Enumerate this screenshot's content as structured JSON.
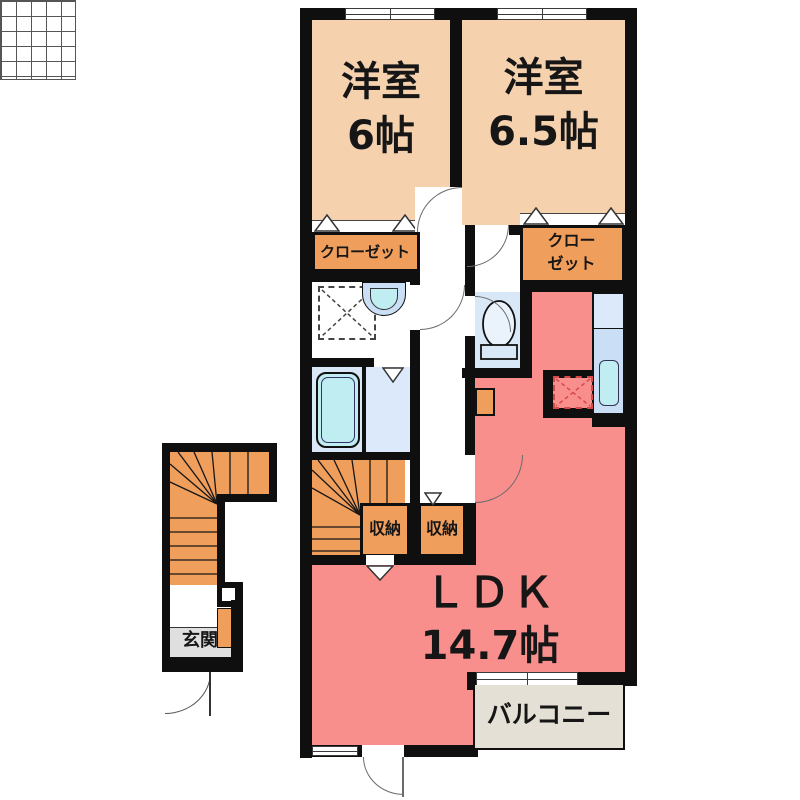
{
  "rooms": {
    "bedroom1": {
      "label": "洋室",
      "size": "6帖"
    },
    "bedroom2": {
      "label": "洋室",
      "size": "6.5帖"
    },
    "ldk": {
      "label": "ＬＤＫ",
      "size": "14.7帖"
    },
    "balcony": {
      "label": "バルコニー"
    },
    "entrance": {
      "label": "玄関"
    },
    "closet_left": {
      "label": "クローゼット"
    },
    "closet_right": {
      "label_line1": "クロー",
      "label_line2": "ゼット"
    },
    "storage_left": {
      "label": "収納"
    },
    "storage_right": {
      "label": "収納"
    }
  },
  "colors": {
    "wall": "#0f0f0f",
    "bedroom_floor": "#F5D1AE",
    "closet_fill": "#EF9E5C",
    "ldk_floor": "#F98F8D",
    "balcony_floor": "#E4E0D6",
    "wet_area_floor": "#D9E8F7",
    "fixture_cyan": "#BFEDF2",
    "counter_blue": "#CADEF5",
    "counter_blue_light": "#DCE9FA",
    "entrance_floor": "#DFDFDF",
    "fridge_dash_red": "#D84848"
  }
}
